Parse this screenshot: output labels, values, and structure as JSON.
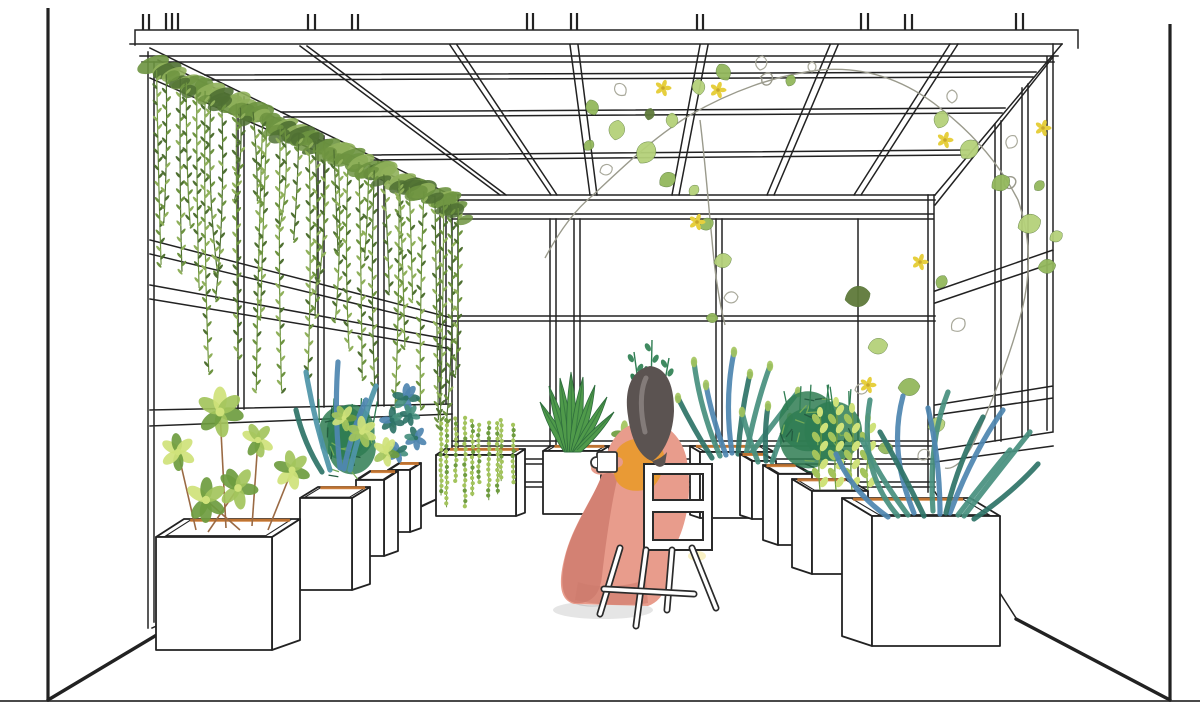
{
  "meta": {
    "title": "Winter-garden greenhouse interior - architectural line perspective with watercolor plants and a seated figure",
    "canvas_w": 1200,
    "canvas_h": 718
  },
  "palette": {
    "ink": "#222222",
    "inkSoft": "#4a4a4a",
    "paper": "#ffffff",
    "stemGray": "#9a9a8c",
    "vineDark": "#4f7032",
    "vineMid": "#6d9340",
    "vineLight": "#8fb05a",
    "leafLight": "#b5d17a",
    "leafMid": "#93b85c",
    "leafDark": "#5f7a3a",
    "leafOutline": "#a8a89a",
    "flowerYellow": "#e6cf3e",
    "flowerCenter": "#c9a82c",
    "jadeLight": "#cfe27a",
    "jadeMid": "#a3c45c",
    "jadeDark": "#6e9c3f",
    "bushDark": "#2f7d52",
    "bushMid": "#74ab58",
    "bushDeep": "#245c41",
    "sprigDark": "#3f8a60",
    "tealDeep": "#2f7468",
    "teal": "#48907f",
    "tealBlue": "#4f94a8",
    "blue": "#4f86b0",
    "soil": "#cd7a32",
    "stemBrown": "#9a6a44",
    "hair": "#5b5351",
    "hairLight": "#8d8683",
    "skin": "#e8a88d",
    "dress": "#e89c8c",
    "dressDeep": "#cd7b6d",
    "shawl": "#e89a2e",
    "aloGreen": "#4f9a4a",
    "aloDark": "#2d6b3c",
    "shadow": "#dedede"
  },
  "scene": {
    "labels": {
      "canvas": "greenhouse interior perspective drawing",
      "ceiling": "steel roof frame grid",
      "back_wall": "glazed back wall with mullions",
      "left_wall": "glazed left wall with hanging vine curtain",
      "right_wall": "glazed right wall with climbing vine",
      "floor": "floor line and room borders",
      "curtain": "hanging vine curtain on left wall",
      "ceiling_vine": "climbing vine with yellow flowers along roof and right wall",
      "back_row": "cube planters along back wall",
      "left_row": "receding row of white cube planters, left",
      "right_row": "receding row of white cube planters, right",
      "woman": "woman seated with her back to viewer holding a mug",
      "chair": "white four-leg chair with square backrest",
      "hair": "dark hair of seated woman"
    }
  },
  "planters": {
    "left_row": [
      {
        "x": 156,
        "y": 537,
        "w": 116,
        "h": 113,
        "dx": 28,
        "dy": -18,
        "plant": "L1"
      },
      {
        "x": 300,
        "y": 498,
        "w": 52,
        "h": 92,
        "dx": 18,
        "dy": -11,
        "plant": "L2"
      },
      {
        "x": 356,
        "y": 480,
        "w": 28,
        "h": 76,
        "dx": 14,
        "dy": -9,
        "plant": "L3"
      },
      {
        "x": 388,
        "y": 470,
        "w": 22,
        "h": 62,
        "dx": 11,
        "dy": -7,
        "plant": "L4"
      }
    ],
    "right_row": [
      {
        "x": 872,
        "y": 516,
        "w": 128,
        "h": 130,
        "dx": -30,
        "dy": -18,
        "plant": "R1"
      },
      {
        "x": 812,
        "y": 491,
        "w": 56,
        "h": 83,
        "dx": -20,
        "dy": -12,
        "plant": "R2"
      },
      {
        "x": 778,
        "y": 474,
        "w": 34,
        "h": 71,
        "dx": -15,
        "dy": -9,
        "plant": "R3"
      },
      {
        "x": 752,
        "y": 461,
        "w": 24,
        "h": 58,
        "dx": -12,
        "dy": -7,
        "plant": "R4"
      }
    ],
    "back_row": [
      {
        "x": 436,
        "y": 455,
        "w": 80,
        "h": 61,
        "dx": 9,
        "dy": -6,
        "plant": "B1"
      },
      {
        "x": 543,
        "y": 451,
        "w": 58,
        "h": 63,
        "dx": 8,
        "dy": -5,
        "plant": "B2"
      },
      {
        "x": 700,
        "y": 452,
        "w": 74,
        "h": 66,
        "dx": -10,
        "dy": -6,
        "plant": "B3"
      }
    ]
  },
  "plants": {
    "L1": {
      "type": "jade_stems",
      "seed": 9,
      "stems": [
        [
          196,
          530,
          178,
          452
        ],
        [
          226,
          528,
          220,
          412
        ],
        [
          252,
          526,
          258,
          440
        ],
        [
          268,
          530,
          292,
          470
        ],
        [
          208,
          532,
          238,
          488
        ],
        [
          240,
          530,
          206,
          500
        ]
      ]
    },
    "L2": {
      "type": "mixed_blue",
      "arms": [
        [
          330,
          470,
          314,
          420,
          306,
          372,
          "tealBlue"
        ],
        [
          340,
          468,
          334,
          414,
          338,
          362,
          "blue"
        ],
        [
          350,
          470,
          361,
          424,
          376,
          386,
          "tealBlue"
        ],
        [
          322,
          472,
          304,
          444,
          296,
          410,
          "tealDeep"
        ],
        [
          344,
          469,
          352,
          430,
          366,
          400,
          "blue"
        ]
      ],
      "rosettes": [
        [
          362,
          432,
          13
        ],
        [
          386,
          452,
          12
        ],
        [
          344,
          418,
          11
        ]
      ],
      "cols": [
        "jadeLight",
        "jadeMid",
        "jadeDark"
      ]
    },
    "L3": {
      "type": "bush",
      "cx": 344,
      "cy": 448,
      "rx": 30,
      "ry": 36,
      "seed": 3
    },
    "L4": {
      "type": "rosettes",
      "items": [
        [
          392,
          420,
          11
        ],
        [
          406,
          398,
          12
        ],
        [
          416,
          438,
          10
        ],
        [
          398,
          452,
          9
        ],
        [
          410,
          415,
          9
        ]
      ],
      "cols": [
        "tealDeep",
        "teal",
        "blue"
      ]
    },
    "B1": {
      "type": "beads",
      "cx": 476,
      "rim": 450,
      "width": 70,
      "strands": 10,
      "seed": 11
    },
    "B2": {
      "type": "aloe",
      "base": [
        572,
        452
      ],
      "tips": [
        [
          540,
          402
        ],
        [
          549,
          386
        ],
        [
          560,
          378
        ],
        [
          571,
          372
        ],
        [
          583,
          377
        ],
        [
          595,
          385
        ],
        [
          607,
          397
        ],
        [
          614,
          412
        ]
      ]
    },
    "B3": {
      "type": "arms",
      "tips": true,
      "arms": [
        [
          720,
          456,
          700,
          410,
          694,
          362,
          "teal"
        ],
        [
          732,
          453,
          724,
          400,
          734,
          352,
          "blue"
        ],
        [
          746,
          455,
          756,
          404,
          770,
          366,
          "teal"
        ],
        [
          712,
          458,
          694,
          430,
          678,
          398,
          "tealDeep"
        ],
        [
          752,
          452,
          776,
          420,
          798,
          392,
          "teal"
        ],
        [
          738,
          454,
          741,
          412,
          750,
          374,
          "tealDeep"
        ],
        [
          726,
          455,
          712,
          418,
          706,
          385,
          "blue"
        ]
      ]
    },
    "R1": {
      "type": "arms",
      "tips": false,
      "arms": [
        [
          898,
          516,
          858,
          470,
          870,
          400,
          "teal"
        ],
        [
          914,
          513,
          888,
          452,
          903,
          396,
          "blue"
        ],
        [
          933,
          511,
          928,
          442,
          948,
          392,
          "teal"
        ],
        [
          950,
          513,
          973,
          452,
          1003,
          410,
          "blue"
        ],
        [
          964,
          516,
          998,
          472,
          1030,
          432,
          "teal"
        ],
        [
          924,
          516,
          903,
          472,
          880,
          432,
          "tealDeep"
        ],
        [
          946,
          513,
          958,
          462,
          983,
          417,
          "tealDeep"
        ],
        [
          888,
          517,
          852,
          492,
          836,
          454,
          "blue"
        ],
        [
          974,
          519,
          1013,
          492,
          1038,
          464,
          "tealDeep"
        ],
        [
          940,
          514,
          940,
          460,
          928,
          408,
          "blue"
        ],
        [
          908,
          515,
          880,
          478,
          862,
          440,
          "teal"
        ],
        [
          958,
          515,
          985,
          480,
          1010,
          450,
          "teal"
        ]
      ]
    },
    "R2": {
      "type": "strings",
      "cx": 842,
      "rim": 490,
      "stems": [
        -22,
        -6,
        10,
        26
      ],
      "tops": [
        412,
        402,
        408,
        418
      ],
      "seed": 5
    },
    "R3": {
      "type": "bush",
      "cx": 818,
      "cy": 438,
      "rx": 36,
      "ry": 40,
      "seed": 4
    },
    "R4": {
      "type": "arms",
      "tips": true,
      "arms": [
        [
          758,
          462,
          748,
          436,
          742,
          412,
          "teal"
        ],
        [
          766,
          461,
          764,
          432,
          768,
          406,
          "tealDeep"
        ],
        [
          772,
          462,
          780,
          438,
          790,
          418,
          "teal"
        ]
      ]
    },
    "ACC1": {
      "type": "sprigs",
      "stems": [
        [
          640,
          396,
          634,
          352
        ],
        [
          651,
          392,
          652,
          340
        ],
        [
          662,
          398,
          669,
          358
        ]
      ]
    },
    "ACC2": {
      "type": "rosettes",
      "items": [
        [
          624,
          434,
          11
        ]
      ],
      "cols": [
        "jadeMid",
        "jadeDark"
      ]
    }
  },
  "vines": {
    "curtain": {
      "x0": 158,
      "y0": 62,
      "x1": 456,
      "y1": 200,
      "strands": 34,
      "maxY": 418,
      "seed": 7
    },
    "ceiling": {
      "leaves": [
        [
          595,
          115,
          16,
          -20,
          "m"
        ],
        [
          615,
          140,
          20,
          10,
          "l"
        ],
        [
          640,
          163,
          24,
          30,
          "l"
        ],
        [
          660,
          185,
          18,
          55,
          "m"
        ],
        [
          625,
          95,
          14,
          -40,
          "o"
        ],
        [
          672,
          128,
          15,
          0,
          "l"
        ],
        [
          600,
          172,
          13,
          70,
          "o"
        ],
        [
          585,
          150,
          12,
          40,
          "m"
        ],
        [
          648,
          120,
          12,
          15,
          "d"
        ],
        [
          700,
          95,
          16,
          -10,
          "l"
        ],
        [
          728,
          80,
          18,
          -30,
          "m"
        ],
        [
          760,
          70,
          14,
          10,
          "o"
        ],
        [
          788,
          86,
          12,
          25,
          "m"
        ],
        [
          812,
          72,
          10,
          0,
          "o"
        ],
        [
          938,
          128,
          18,
          20,
          "l"
        ],
        [
          962,
          158,
          22,
          40,
          "l"
        ],
        [
          992,
          188,
          20,
          60,
          "m"
        ],
        [
          1018,
          228,
          24,
          70,
          "l"
        ],
        [
          1038,
          268,
          18,
          80,
          "m"
        ],
        [
          952,
          103,
          13,
          0,
          "o"
        ],
        [
          1008,
          148,
          14,
          30,
          "o"
        ],
        [
          1035,
          190,
          12,
          45,
          "m"
        ],
        [
          1050,
          240,
          14,
          60,
          "l"
        ],
        [
          845,
          300,
          26,
          75,
          "d"
        ],
        [
          868,
          348,
          20,
          80,
          "l"
        ],
        [
          898,
          388,
          22,
          85,
          "m"
        ],
        [
          928,
          428,
          18,
          70,
          "l"
        ],
        [
          952,
          330,
          16,
          50,
          "o"
        ],
        [
          938,
          288,
          14,
          30,
          "m"
        ],
        [
          878,
          448,
          15,
          90,
          "m"
        ],
        [
          918,
          458,
          13,
          60,
          "o"
        ],
        [
          855,
          390,
          13,
          80,
          "o"
        ],
        [
          700,
          228,
          15,
          60,
          "m"
        ],
        [
          714,
          263,
          18,
          75,
          "l"
        ],
        [
          724,
          298,
          14,
          85,
          "o"
        ],
        [
          706,
          318,
          12,
          90,
          "m"
        ],
        [
          690,
          195,
          12,
          40,
          "l"
        ]
      ],
      "flowers": [
        [
          663,
          88
        ],
        [
          718,
          90
        ],
        [
          945,
          140
        ],
        [
          1043,
          128
        ],
        [
          697,
          222
        ],
        [
          868,
          385
        ],
        [
          920,
          262
        ]
      ]
    }
  }
}
